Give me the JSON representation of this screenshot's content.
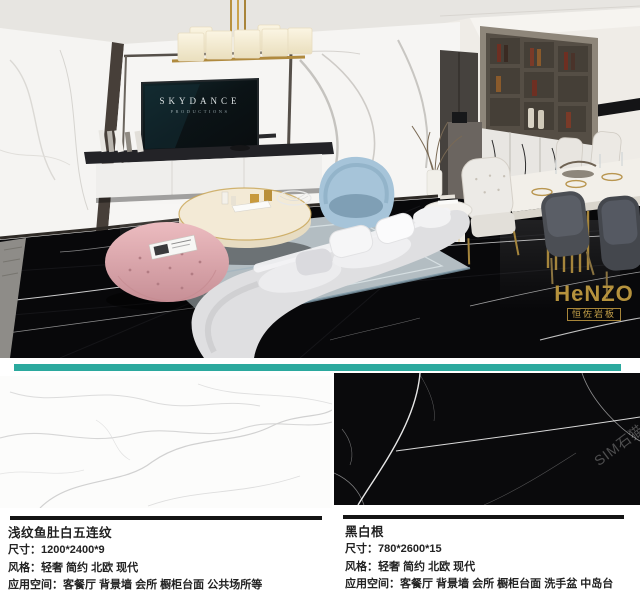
{
  "scene": {
    "tv": {
      "brand": "SKYDANCE",
      "subtitle": "PRODUCTIONS"
    },
    "logo": {
      "text": "HeNZO",
      "subtitle": "恒佐岩板"
    },
    "watermark": "SIM石猫"
  },
  "colors": {
    "divider_teal": "#2ba99e",
    "brand_gold": "#b5923d",
    "ottoman_pink": "#e5b3b8",
    "chair_blue": "#a6c4d9",
    "floor_black": "#0a0a0c"
  },
  "products": [
    {
      "name": "浅纹鱼肚白五连纹",
      "lines": [
        "尺寸：1200*2400*9",
        "风格：轻奢 简约 北欧 现代",
        "应用空间：客餐厅 背景墙 会所 橱柜台面 公共场所等"
      ]
    },
    {
      "name": "黑白根",
      "lines": [
        "尺寸：780*2600*15",
        "风格：轻奢 简约 北欧 现代",
        "应用空间：客餐厅 背景墙 会所 橱柜台面 洗手盆 中岛台"
      ]
    }
  ]
}
